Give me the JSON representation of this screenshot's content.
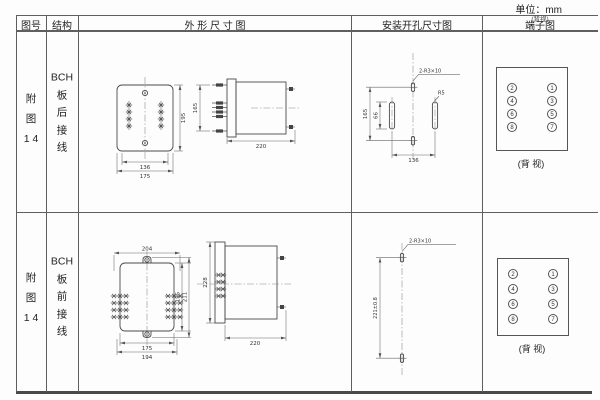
{
  "unit_label": "单位：mm",
  "header": {
    "figure": "图号",
    "structure": "结构",
    "outline": "外 形 尺 寸 图",
    "mounting": "安装开孔尺寸图",
    "terminal": "端子图",
    "terminal_overlay": "(背视)"
  },
  "rows": [
    {
      "figure_no": "附\n图\n1 4",
      "structure": "BCH\n板\n后\n接\n线",
      "outline": {
        "front_width_inner": "136",
        "front_width_outer": "175",
        "front_height": "195",
        "side_height": "165",
        "side_depth": "220"
      },
      "mounting": {
        "slot_label": "2-R3×10",
        "radius_label": "R5",
        "height": "165",
        "slot_length": "66",
        "width": "136"
      },
      "terminal": {
        "left": [
          "2",
          "4",
          "6",
          "8"
        ],
        "right": [
          "1",
          "3",
          "5",
          "7"
        ],
        "caption": "(背 视)"
      }
    },
    {
      "figure_no": "附\n图\n1 4",
      "structure": "BCH\n板\n前\n接\n线",
      "outline": {
        "front_width_top": "204",
        "front_width_inner": "175",
        "front_width_outer": "194",
        "front_height_inner": "195",
        "front_height_outer": "211",
        "side_height": "228",
        "side_depth": "220"
      },
      "mounting": {
        "slot_label": "2-R3×10",
        "height": "221±0.8"
      },
      "terminal": {
        "left": [
          "2",
          "4",
          "6",
          "8"
        ],
        "right": [
          "1",
          "3",
          "5",
          "7"
        ],
        "caption": "(背 视)"
      }
    }
  ]
}
